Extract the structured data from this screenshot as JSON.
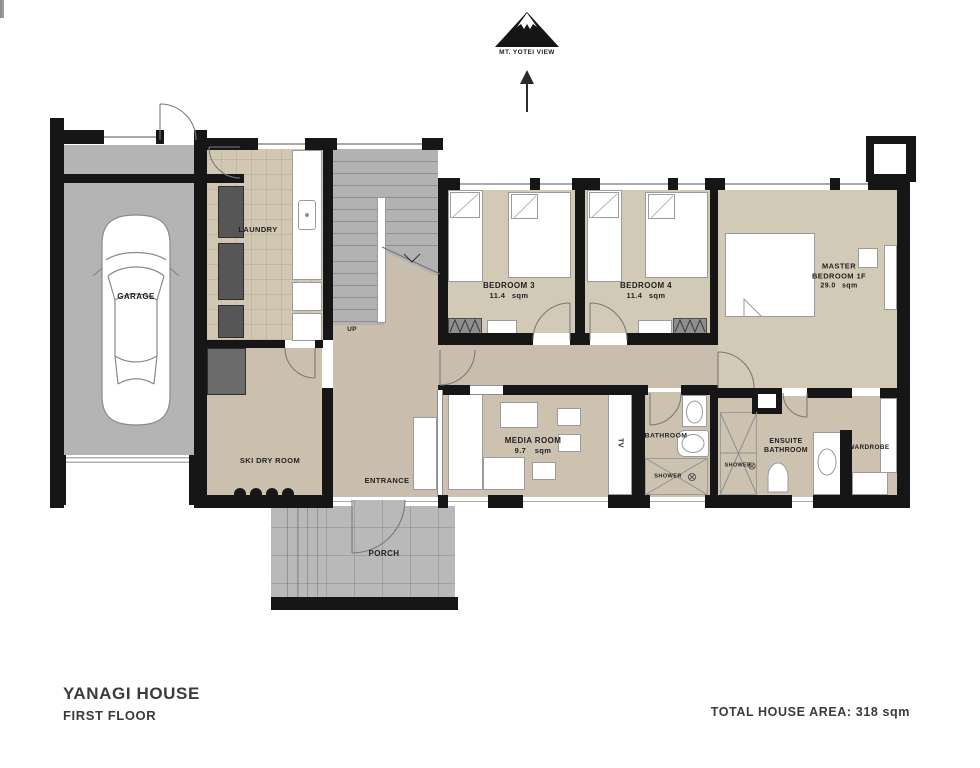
{
  "compass": {
    "label": "MT. YOTEI VIEW"
  },
  "rooms": {
    "garage": {
      "label": "GARAGE"
    },
    "laundry": {
      "label": "LAUNDRY"
    },
    "stairs": {
      "up": "UP"
    },
    "bedroom3": {
      "label": "BEDROOM 3",
      "area": "11.4 sqm"
    },
    "bedroom4": {
      "label": "BEDROOM 4",
      "area": "11.4 sqm"
    },
    "master": {
      "line1": "MASTER",
      "line2": "BEDROOM 1F",
      "area": "29.0 sqm"
    },
    "media": {
      "label": "MEDIA ROOM",
      "area": "9.7 sqm"
    },
    "tv": {
      "label": "TV"
    },
    "bathroom": {
      "label": "BATHROOM",
      "shower": "SHOWER"
    },
    "ensuite": {
      "line1": "ENSUITE",
      "line2": "BATHROOM",
      "shower": "SHOWER"
    },
    "wardrobe": {
      "label": "WARDROBE"
    },
    "skidry": {
      "label": "SKI DRY ROOM"
    },
    "entrance": {
      "label": "ENTRANCE"
    },
    "porch": {
      "label": "PORCH"
    }
  },
  "titleblock": {
    "house": "YANAGI HOUSE",
    "floor": "FIRST FLOOR"
  },
  "footer": {
    "total_area": "TOTAL HOUSE AREA: 318 sqm"
  },
  "colors": {
    "wall": "#161616",
    "floor_beige": "#d3c9b7",
    "floor_beige_dark": "#c9bead",
    "floor_gray": "#b4b4b4",
    "furniture_outline": "#9b9b9b"
  }
}
